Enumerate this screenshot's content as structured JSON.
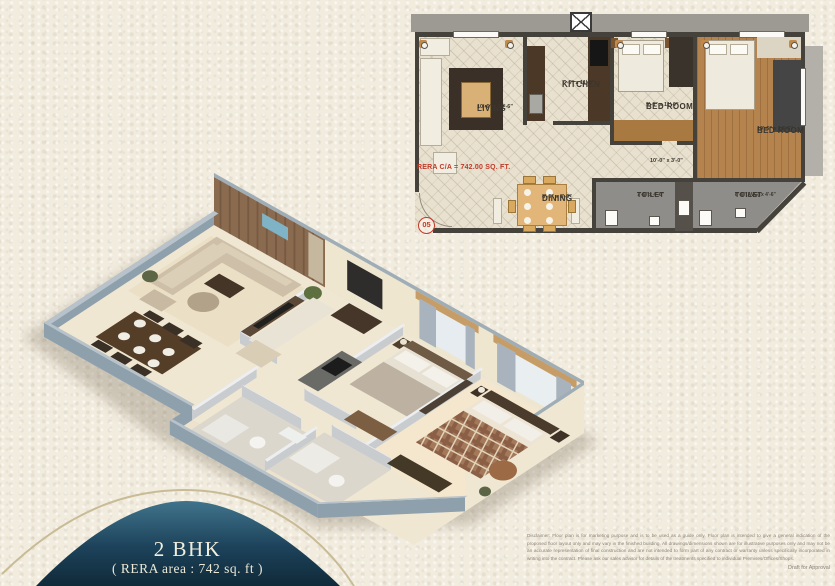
{
  "title_badge": {
    "unit_type": "2 BHK",
    "rera_area": "( RERA area : 742 sq. ft )"
  },
  "floor_plan": {
    "rera_carpet_area": "RERA C/A = 742.00 SQ. FT.",
    "unit_number": "05",
    "rooms": {
      "living": {
        "name": "LIVING",
        "dims": "10'-6\" x 19'-6\""
      },
      "kitchen": {
        "name": "KITCHEN",
        "dims": "7'-6\" x 11'-0\""
      },
      "bedroom1": {
        "name": "BED ROOM",
        "dims": "9'-0\" x 11'-0\""
      },
      "bedroom2": {
        "name": "BED ROOM",
        "dims": "10'-6\" x 14'-6\""
      },
      "dining": {
        "name": "DINING",
        "dims": "8'-0\" x 8'-0\""
      },
      "toilet1": {
        "name": "TOILET",
        "dims": "7'-6\" x 4'-6\""
      },
      "toilet2": {
        "name": "TOILET",
        "dims": "8'-6\"(AVG) x 4'-6\""
      },
      "passage": {
        "dims": "10'-0\" x 3'-0\""
      }
    }
  },
  "footer": {
    "disclaimer": "Disclaimer: Floor plan is for marketing purpose and is to be used as a guide only. Floor plan is intended to give a general indication of the proposed floor layout only and may vary in the finished building. All drawings/dimensions shown are for illustrative purposes only and may not be an accurate representation of final construction and are not intended to form part of any contract or warranty unless specifically incorporated in writing into the contract. Please ask our sales advisor for details of the treatments specified to individual Premises/Offices/Shops.",
    "draft_note": "Draft for Approval"
  },
  "colors": {
    "paper": "#f2ecdf",
    "accent-navy": "#16354a",
    "gold": "#c8bb95",
    "plan-red": "#c23a28",
    "wood": "#b5834e",
    "wall-dark": "#45423c",
    "wall-3d": "#8ea0ac",
    "floor-3d": "#f0e7d3"
  }
}
